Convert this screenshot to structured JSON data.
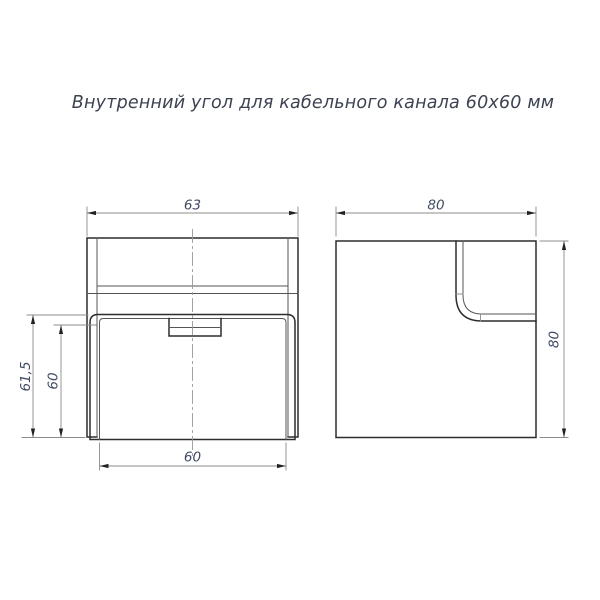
{
  "title": "Внутренний угол для кабельного канала 60х60 мм",
  "views": {
    "front": {
      "dims": {
        "top_width": "63",
        "outer_height": "61,5",
        "inner_height": "60",
        "bottom_width": "60"
      }
    },
    "side": {
      "dims": {
        "top_width": "80",
        "side_height": "80"
      }
    }
  },
  "colors": {
    "outline": "#2d2d2d",
    "thin_line": "#8c8c8c",
    "dimension_text": "#414a63",
    "background": "#ffffff"
  }
}
